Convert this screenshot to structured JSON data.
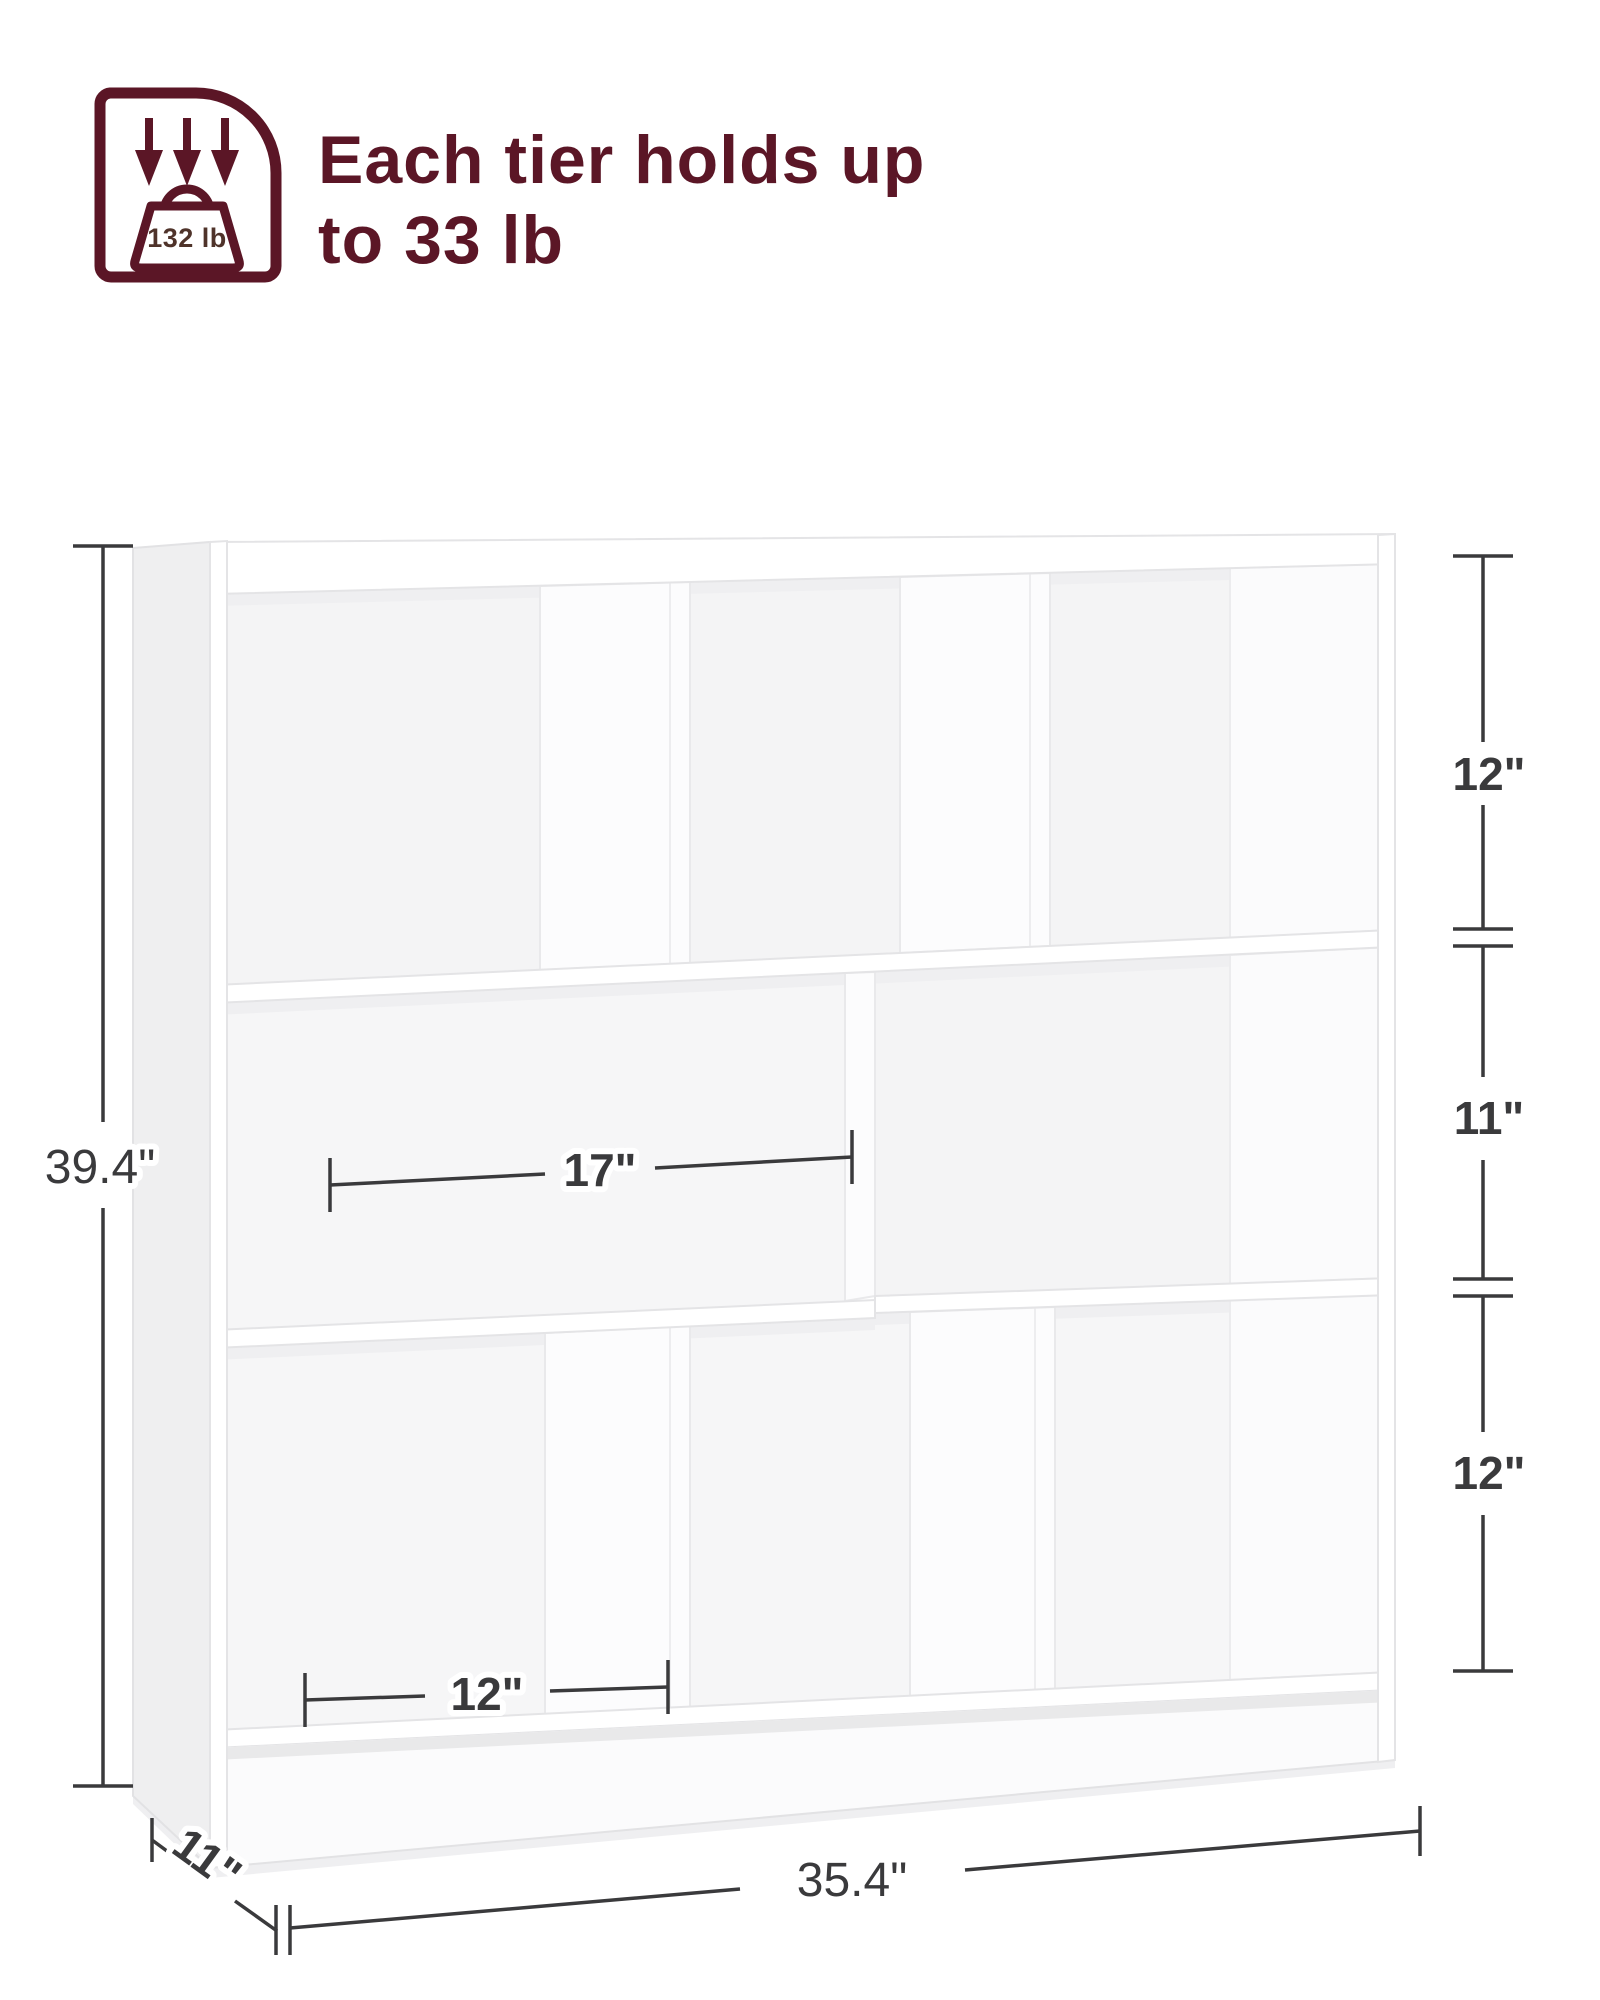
{
  "page": {
    "background": "#ffffff"
  },
  "capacity_badge": {
    "weight_label": "132 lb",
    "accent_color": "#5b1626"
  },
  "headline": {
    "line1": "Each tier holds up",
    "line2": "to 33 lb",
    "color": "#5b1626"
  },
  "dimension_labels": {
    "overall_height": "39.4\"",
    "top_tier_height": "12\"",
    "middle_tier_height": "11\"",
    "bottom_tier_height": "12\"",
    "middle_compartment_width": "17\"",
    "bottom_compartment_width": "12\"",
    "overall_width": "35.4\"",
    "overall_depth": "11\"",
    "line_color": "#3a3a3c"
  }
}
